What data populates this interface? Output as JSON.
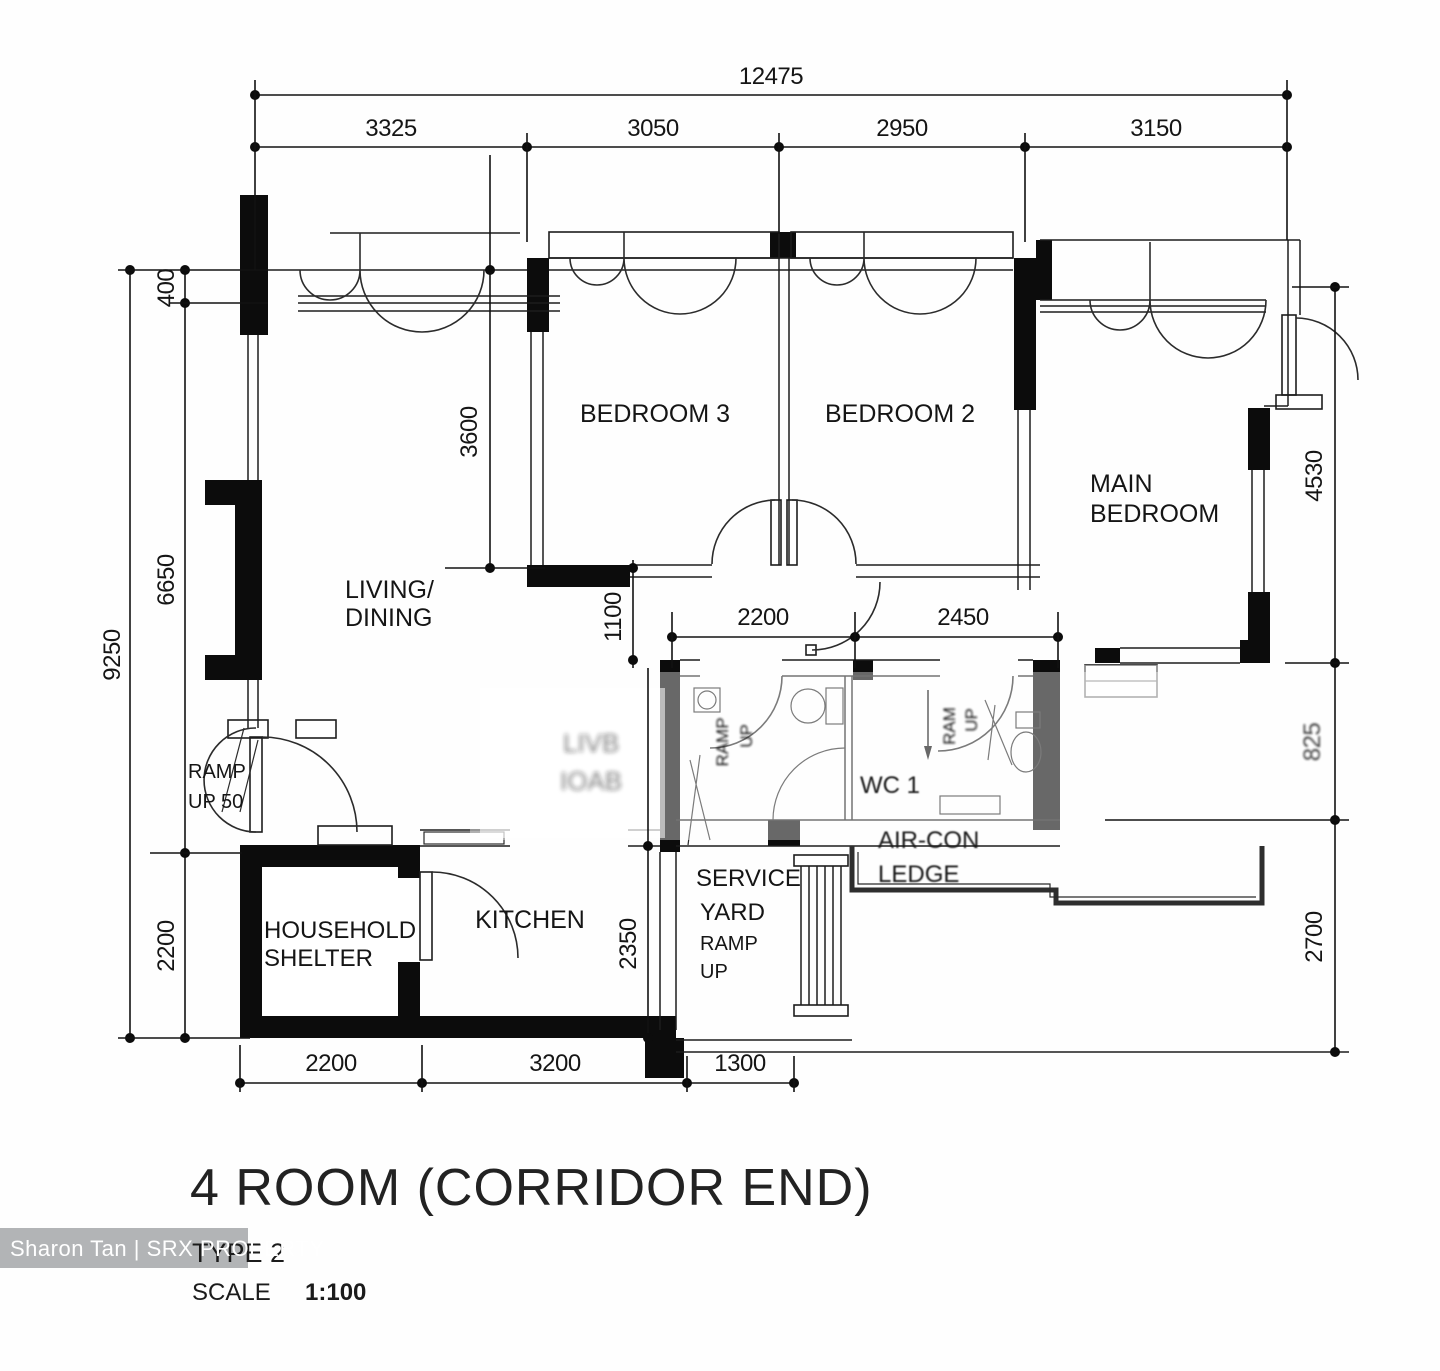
{
  "plan": {
    "rooms": {
      "living_dining": {
        "line1": "LIVING/",
        "line2": "DINING"
      },
      "bedroom3": "BEDROOM 3",
      "bedroom2": "BEDROOM 2",
      "main_bedroom": {
        "line1": "MAIN",
        "line2": "BEDROOM"
      },
      "kitchen": "KITCHEN",
      "household_shelter": {
        "line1": "HOUSEHOLD",
        "line2": "SHELTER"
      },
      "service_yard": {
        "line1": "SERVICE",
        "line2": "YARD"
      },
      "wc": "WC 1",
      "aircon_ledge": {
        "line1": "AIR-CON",
        "line2": "LEDGE"
      }
    },
    "annotations": {
      "entrance_ramp": {
        "line1": "RAMP",
        "line2": "UP 50"
      },
      "service_yard_ramp": {
        "line1": "RAMP",
        "line2": "UP"
      },
      "bath1_ramp": {
        "line1": "RAMP",
        "line2": "UP"
      },
      "wc_ramp": {
        "line1": "RAM",
        "line2": "UP"
      },
      "illegible_smudge": {
        "line1": "LIVB",
        "line2": "IOAB"
      }
    },
    "dimensions": {
      "top_total": "12475",
      "top_segments": [
        "3325",
        "3050",
        "2950",
        "3150"
      ],
      "left_total": "9250",
      "left_segments": [
        "400",
        "6650",
        "2200"
      ],
      "right_segments": [
        "4530",
        "825",
        "2700"
      ],
      "bottom_segments": [
        "2200",
        "3200",
        "1300"
      ],
      "inner": {
        "bedroom_depth": "3600",
        "corridor": "1100",
        "bath_width": "2200",
        "wc_width": "2450",
        "kitchen_depth": "2350"
      }
    }
  },
  "titleblock": {
    "title": "4 ROOM (CORRIDOR END)",
    "type": "TYPE 2",
    "scale_label": "SCALE",
    "scale_value": "1:100"
  },
  "watermark": "Sharon Tan | SRX PROPERTY",
  "colors": {
    "wall": "#0c0c0c",
    "line": "#1d1d1d",
    "watermark_bg": "#a7aaac",
    "paper": "#ffffff"
  }
}
